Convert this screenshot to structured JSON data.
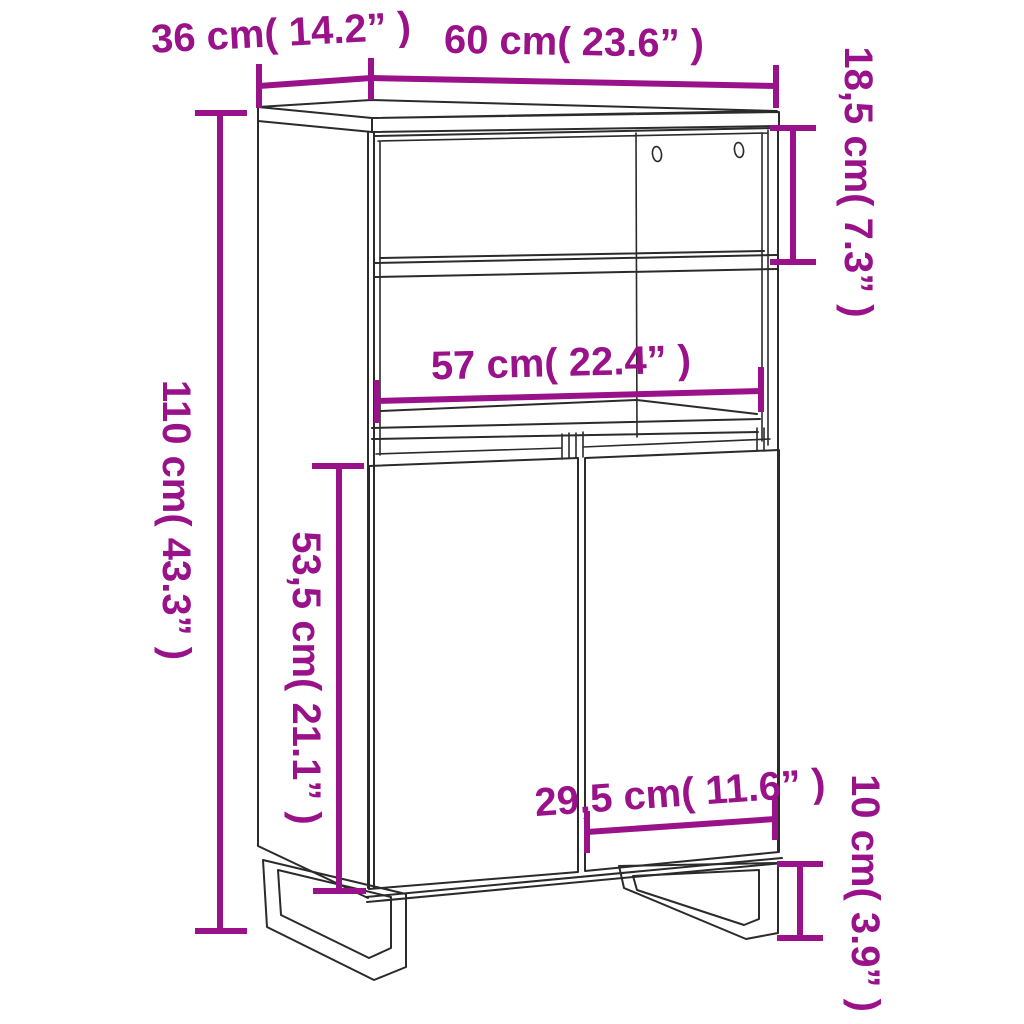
{
  "diagram": {
    "subject": "highboard cabinet line drawing with dimensions",
    "accent_color": "#9A128A",
    "line_color": "#2b2b2b",
    "background_color": "#ffffff",
    "labels": {
      "depth": "36 cm( 14.2” )",
      "width": "60 cm( 23.6” )",
      "upper_compartment_height": "18,5 cm( 7.3” )",
      "total_height": "110 cm( 43.3” )",
      "inner_width": "57 cm( 22.4” )",
      "door_section_height": "53,5 cm( 21.1” )",
      "door_width": "29,5 cm( 11.6” )",
      "leg_height": "10 cm( 3.9” )"
    }
  }
}
